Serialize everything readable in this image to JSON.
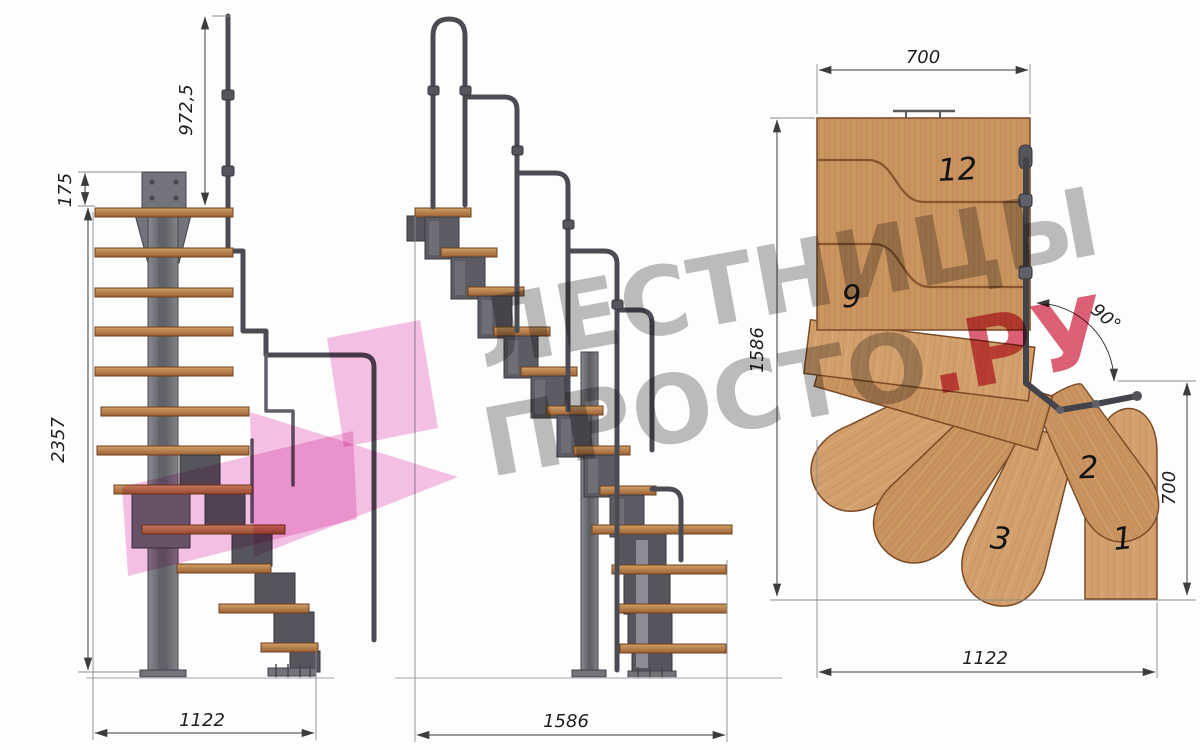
{
  "watermark": {
    "line1": "ЛЕСТНИЦЫ",
    "line2_gray": "ПРОСТО",
    "line2_red": ".РУ"
  },
  "front_view": {
    "dim_handrail_height": "972,5",
    "dim_plate_height": "175",
    "dim_total_height": "2357",
    "dim_base_width": "1122"
  },
  "side_view": {
    "dim_length": "1586"
  },
  "plan_view": {
    "dim_top_width": "700",
    "dim_side_length": "1586",
    "dim_turn_angle": "90°",
    "dim_exit_depth": "700",
    "dim_total_width": "1122",
    "tread_12": "12",
    "tread_9": "9",
    "tread_3": "3",
    "tread_2": "2",
    "tread_1": "1"
  },
  "colors": {
    "watermark_gray": "#b4b4b4",
    "watermark_red": "#d94a62",
    "watermark_pink": "#f3b3dd",
    "wood": "#c9945f",
    "steel": "#5c5c64",
    "dim_line": "#3c3c3c"
  }
}
